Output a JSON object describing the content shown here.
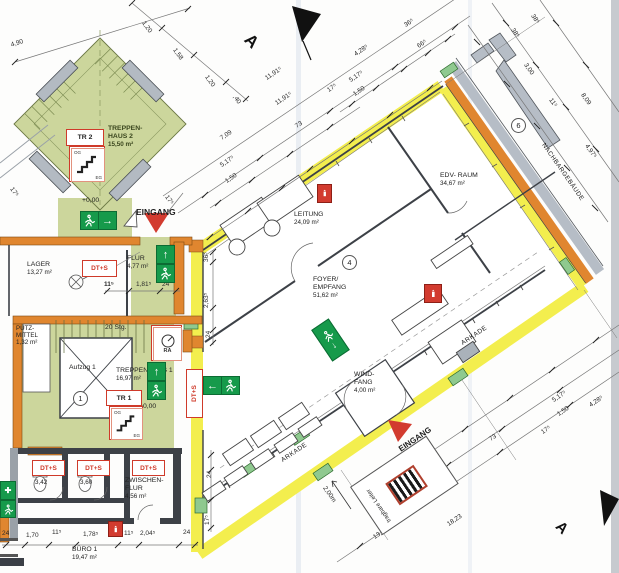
{
  "title": "Erdgeschoss Grundriss",
  "rooms": {
    "th2_l1": "TREPPEN-",
    "th2_l2": "HAUS 2",
    "th2_area": "15,50 m²",
    "tr2": "TR 2",
    "tr1": "TR 1",
    "og": "OG",
    "eg": "EG",
    "lager": "LAGER",
    "lager_area": "13,27 m²",
    "flur": "FLUR",
    "flur_area": "4,77 m²",
    "leitung": "LEITUNG",
    "leitung_area": "24,09 m²",
    "edv": "EDV- RAUM",
    "edv_area": "34,67 m²",
    "foyer_l1": "FOYER/",
    "foyer_l2": "EMPFANG",
    "foyer_area": "51,62 m²",
    "windfang_l1": "WIND-",
    "windfang_l2": "FANG",
    "windfang_area": "4,00 m²",
    "th1": "TREPPENHAUS 1",
    "th1_area": "16,97 m²",
    "aufzug": "Aufzug 1",
    "putz_l1": "PUTZ-",
    "putz_l2": "MITTEL",
    "putz_area": "1,32 m²",
    "zf_l1": "ZWISCHEN-",
    "zf_l2": "FLUR",
    "zf_area": "4,56 m²",
    "buero": "BÜRO 1",
    "buero_area": "19,47 m²",
    "wc1_area": "3,42",
    "wc2_area": "3,60"
  },
  "labels": {
    "eingang": "EINGANG",
    "nachbargebaeude": "NACHBARGEBÄUDE",
    "arkade": "ARKADE",
    "stg": "20 Stg.",
    "level": "+0,00",
    "dts": "DT+S",
    "ra": "RA",
    "ladder": "tragbare Leiter",
    "section": "A",
    "c1": "1",
    "c4": "4",
    "c6": "6"
  },
  "dims": {
    "d01": "1,20",
    "d02": "1,58",
    "d03": "1,20",
    "d04": ",40",
    "d05": "4,90",
    "d06": "17⁵",
    "d07": "11,91⁵",
    "d08": "11,91⁵",
    "d09": "17⁵",
    "d10": "7,09",
    "d11": "5,17⁵",
    "d12": "1,50",
    "d13": "73",
    "d14": "4,28⁵",
    "d15": "5,17⁵",
    "d16": "1,50",
    "d17": "36⁵",
    "d18": "66⁵",
    "d19": "38⁵",
    "d20": "38⁵",
    "d21": "3,00",
    "d22": "11⁵",
    "d23": "8,09",
    "d24": "4,97⁵",
    "d25": "36⁵",
    "d26": "2,63⁵",
    "d27": "24",
    "d28": "17⁵",
    "d29": "24",
    "d30": "11⁵",
    "d31": "1,81⁵",
    "d32": "24",
    "d33": "17⁵",
    "d34": "5,17⁵",
    "d35": "1,50",
    "d36": "4,28⁵",
    "d37": "73",
    "d38": "17⁵",
    "d39": "5,27⁵",
    "d40": "1,50",
    "d41": "18,23",
    "d42": "13,40",
    "d43": "2,00m",
    "d44": "2,00m",
    "d45": "24",
    "d46": "1,70",
    "d47": "11⁵",
    "d48": "1,78⁵",
    "d49": "11⁵",
    "d50": "2,04⁵",
    "d51": "24"
  },
  "icons": {
    "arrow_up": "↑",
    "arrow_right": "→",
    "arrow_left": "←",
    "arrow_down": "↓",
    "cross": "✚"
  },
  "colors": {
    "escape_route_yellow": "#f3ee4e",
    "wall_orange": "#e0862f",
    "stair_green": "#ccd69c",
    "exit_green": "#169a4b",
    "alarm_red": "#d23b2f",
    "neighbor_gray": "#b6bdc6"
  }
}
